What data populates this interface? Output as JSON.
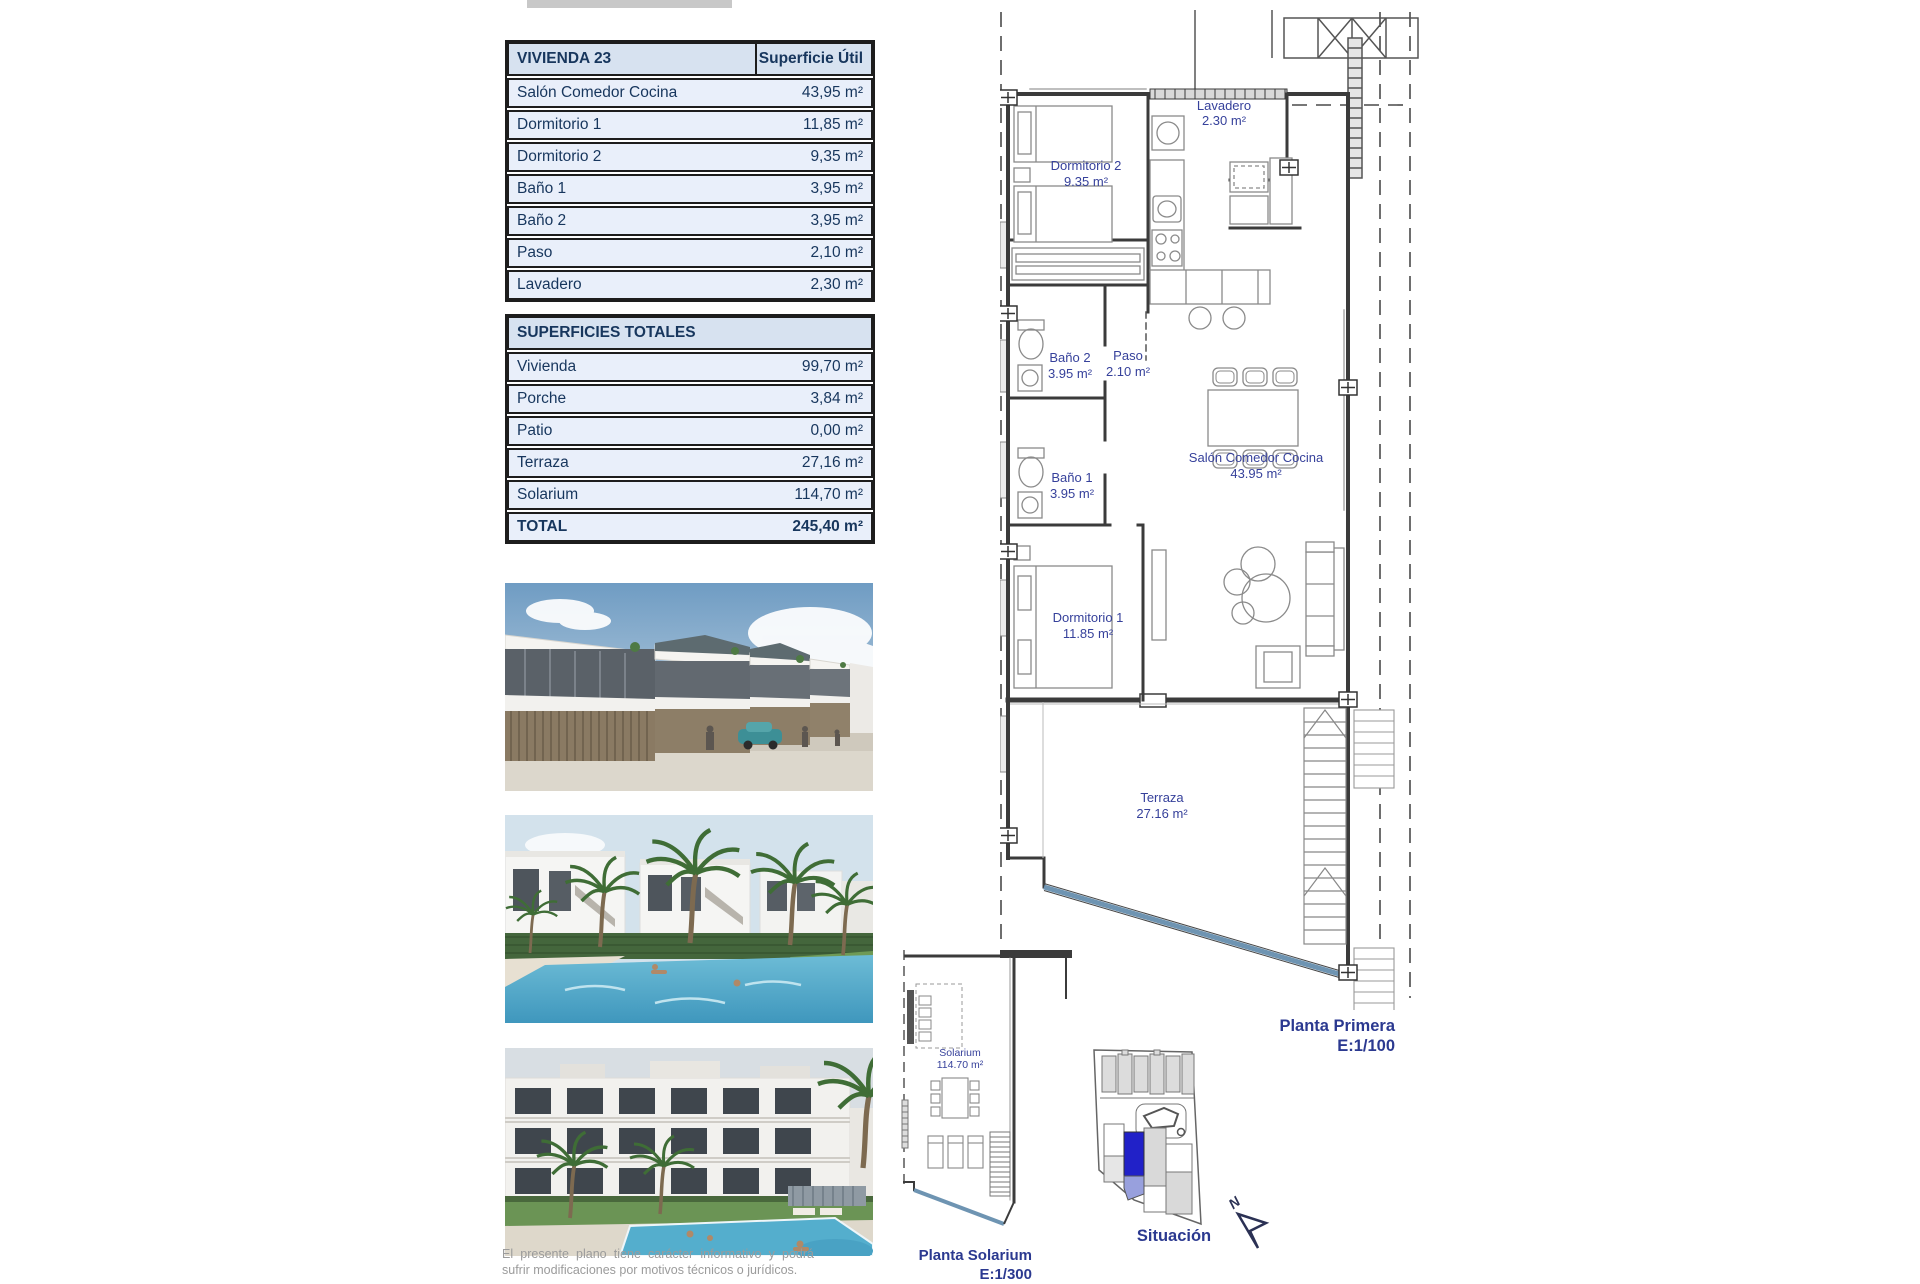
{
  "unit_table": {
    "title": "VIVIENDA 23",
    "header_value": "Superficie Útil",
    "rows": [
      {
        "label": "Salón Comedor Cocina",
        "value": "43,95 m²"
      },
      {
        "label": "Dormitorio 1",
        "value": "11,85 m²"
      },
      {
        "label": "Dormitorio 2",
        "value": "9,35 m²"
      },
      {
        "label": "Baño 1",
        "value": "3,95 m²"
      },
      {
        "label": "Baño 2",
        "value": "3,95 m²"
      },
      {
        "label": "Paso",
        "value": "2,10 m²"
      },
      {
        "label": "Lavadero",
        "value": "2,30 m²"
      }
    ]
  },
  "totals_table": {
    "title": "SUPERFICIES TOTALES",
    "rows": [
      {
        "label": "Vivienda",
        "value": "99,70 m²"
      },
      {
        "label": "Porche",
        "value": "3,84 m²"
      },
      {
        "label": "Patio",
        "value": "0,00 m²"
      },
      {
        "label": "Terraza",
        "value": "27,16 m²"
      },
      {
        "label": "Solarium",
        "value": "114,70 m²"
      }
    ],
    "total": {
      "label": "TOTAL",
      "value": "245,40 m²"
    }
  },
  "floor_plan": {
    "caption": "Planta Primera",
    "scale": "E:1/100",
    "rooms": [
      {
        "name": "Lavadero",
        "area": "2.30 m²"
      },
      {
        "name": "Dormitorio 2",
        "area": "9.35 m²"
      },
      {
        "name": "Baño 2",
        "area": "3.95 m²"
      },
      {
        "name": "Paso",
        "area": "2.10 m²"
      },
      {
        "name": "Salón Comedor Cocina",
        "area": "43.95 m²"
      },
      {
        "name": "Baño 1",
        "area": "3.95 m²"
      },
      {
        "name": "Dormitorio 1",
        "area": "11.85 m²"
      },
      {
        "name": "Terraza",
        "area": "27.16 m²"
      }
    ]
  },
  "solarium_plan": {
    "caption": "Planta Solarium",
    "scale": "E:1/300",
    "room": {
      "name": "Solarium",
      "area": "114.70 m²"
    }
  },
  "site_plan": {
    "caption": "Situación",
    "north_label": "N"
  },
  "disclaimer": "El presente plano tiene carácter informativo y podrá sufrir modificaciones por motivos técnicos o jurídicos.",
  "colors": {
    "table_text_navy": "#17365d",
    "table_header_bg": "#d7e2f0",
    "table_row_bg": "#e9effa",
    "plan_label_blue": "#36419b",
    "caption_navy": "#2b3990",
    "terrace_edge_blue": "#6e94b2",
    "highlight_plot_blue": "#2121c8",
    "highlight_plot_light": "#98a0dd"
  }
}
